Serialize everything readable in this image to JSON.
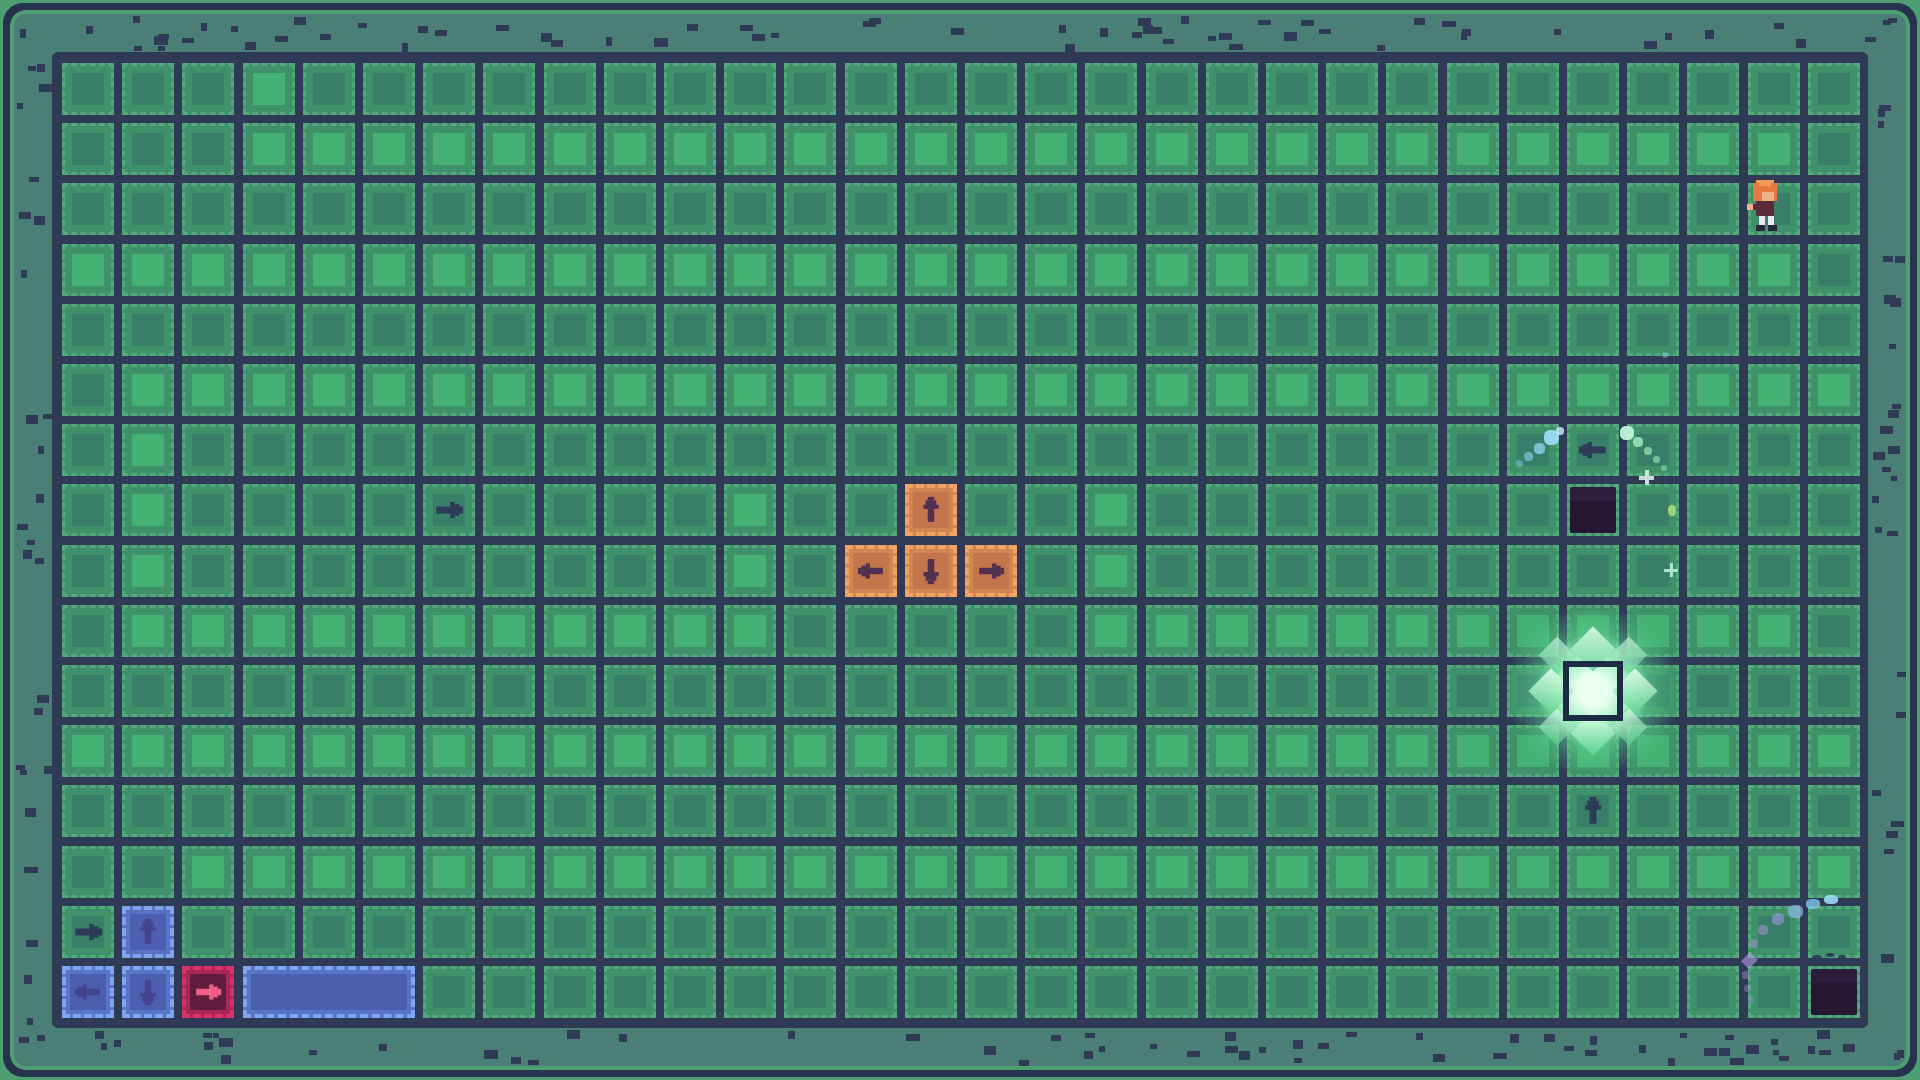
{
  "meta": {
    "app": "pixel-grid-puzzle-game",
    "scene": "garden-grid-level",
    "visible_text": "none"
  },
  "grid": {
    "cols": 30,
    "rows": 16,
    "origin_x": 62,
    "origin_y": 63,
    "pitch": 60.2,
    "cell_size": 52,
    "bright_cell_ranges_by_row": {
      "0": [
        [
          3,
          3
        ]
      ],
      "1": [
        [
          3,
          28
        ]
      ],
      "3": [
        [
          0,
          28
        ]
      ],
      "5": [
        [
          1,
          29
        ]
      ],
      "6": [
        [
          1,
          1
        ]
      ],
      "7": [
        [
          1,
          1
        ],
        [
          11,
          11
        ],
        [
          17,
          17
        ]
      ],
      "8": [
        [
          1,
          1
        ],
        [
          11,
          11
        ],
        [
          17,
          17
        ]
      ],
      "9": [
        [
          1,
          11
        ],
        [
          17,
          28
        ]
      ],
      "11": [
        [
          0,
          29
        ]
      ],
      "13": [
        [
          2,
          29
        ]
      ]
    }
  },
  "pieces": {
    "orange_arrow_tiles": [
      {
        "col": 14,
        "row": 7,
        "dir": "up"
      },
      {
        "col": 13,
        "row": 8,
        "dir": "left"
      },
      {
        "col": 14,
        "row": 8,
        "dir": "down"
      },
      {
        "col": 15,
        "row": 8,
        "dir": "right"
      }
    ],
    "blue_arrow_tiles": [
      {
        "col": 1,
        "row": 14,
        "dir": "up"
      },
      {
        "col": 0,
        "row": 15,
        "dir": "left"
      },
      {
        "col": 1,
        "row": 15,
        "dir": "down"
      }
    ],
    "pink_arrow_tiles": [
      {
        "col": 2,
        "row": 15,
        "dir": "right"
      }
    ],
    "blue_bar": {
      "col": 3,
      "row": 15,
      "span": 3
    },
    "ground_arrow_glyphs": [
      {
        "col": 6,
        "row": 7,
        "dir": "right"
      },
      {
        "col": 0,
        "row": 14,
        "dir": "right"
      },
      {
        "col": 25,
        "row": 6,
        "dir": "left"
      },
      {
        "col": 25,
        "row": 12,
        "dir": "up"
      }
    ],
    "dark_holes": [
      {
        "col": 25,
        "row": 7
      },
      {
        "col": 29,
        "row": 15
      }
    ],
    "glow_target": {
      "col": 25,
      "row": 10
    },
    "character": {
      "col": 28,
      "row": 2
    }
  },
  "colors": {
    "bg_navy": "#2e3a56",
    "frame_navy": "#27334e",
    "frame_green": "#4d9f72",
    "band_teal": "#4b7e74",
    "speckle": "#2e3a56",
    "cell_frame": "#3f9169",
    "cell_dash": "#54a87b",
    "cell_inner_dark": "#397e68",
    "cell_inner_bright": "#45b175",
    "glyph_arrow": "#2d3b57",
    "orange_border": "#f0a362",
    "orange_fill": "#d18551",
    "orange_inner": "#c4754b",
    "orange_arrow": "#513050",
    "blue_border": "#7fa5ec",
    "blue_fill": "#5873c8",
    "blue_inner": "#4c5fae",
    "blue_arrow": "#454390",
    "pink_border": "#d6336b",
    "pink_fill": "#a82753",
    "pink_inner": "#5f1c3e",
    "pink_arrow": "#f06087",
    "hole_top": "#2c1c3e",
    "hole_fill": "#241732",
    "glow_border": "#1e2b47",
    "glow_core": "#eafff2",
    "glow_mid": "#9ef0bd",
    "glow_outer": "#5fd694",
    "char_hair": "#e5793f",
    "char_hair_light": "#f29b57",
    "char_skin": "#f0b288",
    "char_body": "#5c2b3b",
    "char_legs": "#e9e9f0",
    "char_shoes": "#262738"
  },
  "particles": [
    {
      "x": 1516,
      "y": 460,
      "w": 7,
      "h": 7,
      "color": "#86d7f2",
      "opacity": 0.45,
      "shape": "dot"
    },
    {
      "x": 1524,
      "y": 452,
      "w": 9,
      "h": 9,
      "color": "#86d7f2",
      "opacity": 0.6,
      "shape": "dot"
    },
    {
      "x": 1534,
      "y": 443,
      "w": 11,
      "h": 11,
      "color": "#8fd9f4",
      "opacity": 0.75,
      "shape": "dot"
    },
    {
      "x": 1544,
      "y": 430,
      "w": 15,
      "h": 15,
      "color": "#9adcf6",
      "opacity": 0.95,
      "shape": "dot"
    },
    {
      "x": 1556,
      "y": 427,
      "w": 8,
      "h": 8,
      "color": "#c9ecfa",
      "opacity": 0.8,
      "shape": "dot"
    },
    {
      "x": 1620,
      "y": 426,
      "w": 14,
      "h": 14,
      "color": "#bff2dd",
      "opacity": 0.95,
      "shape": "dot"
    },
    {
      "x": 1633,
      "y": 437,
      "w": 10,
      "h": 10,
      "color": "#a5ecc2",
      "opacity": 0.8,
      "shape": "dot"
    },
    {
      "x": 1644,
      "y": 447,
      "w": 8,
      "h": 8,
      "color": "#a5ecc2",
      "opacity": 0.65,
      "shape": "dot"
    },
    {
      "x": 1653,
      "y": 456,
      "w": 7,
      "h": 7,
      "color": "#a5ecc2",
      "opacity": 0.55,
      "shape": "dot"
    },
    {
      "x": 1661,
      "y": 465,
      "w": 6,
      "h": 6,
      "color": "#a5ecc2",
      "opacity": 0.45,
      "shape": "dot"
    },
    {
      "x": 1639,
      "y": 470,
      "w": 15,
      "h": 15,
      "color": "#d8efe6",
      "opacity": 0.9,
      "shape": "cross"
    },
    {
      "x": 1668,
      "y": 505,
      "w": 8,
      "h": 11,
      "color": "#b9e87e",
      "opacity": 0.75,
      "shape": "dot"
    },
    {
      "x": 1664,
      "y": 563,
      "w": 14,
      "h": 14,
      "color": "#bff2dd",
      "opacity": 0.85,
      "shape": "cross"
    },
    {
      "x": 1662,
      "y": 352,
      "w": 6,
      "h": 6,
      "color": "#86d7f2",
      "opacity": 0.4,
      "shape": "dot"
    },
    {
      "x": 1824,
      "y": 895,
      "w": 14,
      "h": 9,
      "color": "#9adcf6",
      "opacity": 0.9,
      "shape": "dot"
    },
    {
      "x": 1806,
      "y": 899,
      "w": 14,
      "h": 10,
      "color": "#7fc4ee",
      "opacity": 0.8,
      "shape": "dot"
    },
    {
      "x": 1788,
      "y": 905,
      "w": 15,
      "h": 13,
      "color": "#8fb7e8",
      "opacity": 0.7,
      "shape": "dot"
    },
    {
      "x": 1772,
      "y": 913,
      "w": 12,
      "h": 12,
      "color": "#9a9ae0",
      "opacity": 0.6,
      "shape": "dot"
    },
    {
      "x": 1758,
      "y": 925,
      "w": 10,
      "h": 10,
      "color": "#a98fd8",
      "opacity": 0.55,
      "shape": "dot"
    },
    {
      "x": 1749,
      "y": 939,
      "w": 9,
      "h": 9,
      "color": "#a98fd8",
      "opacity": 0.5,
      "shape": "dot"
    },
    {
      "x": 1744,
      "y": 954,
      "w": 11,
      "h": 13,
      "color": "#b49ae2",
      "opacity": 0.6,
      "shape": "diamond"
    },
    {
      "x": 1742,
      "y": 971,
      "w": 8,
      "h": 8,
      "color": "#a98fd8",
      "opacity": 0.45,
      "shape": "dot"
    },
    {
      "x": 1744,
      "y": 985,
      "w": 7,
      "h": 7,
      "color": "#a98fd8",
      "opacity": 0.4,
      "shape": "dot"
    },
    {
      "x": 1748,
      "y": 997,
      "w": 6,
      "h": 6,
      "color": "#a98fd8",
      "opacity": 0.35,
      "shape": "dot"
    },
    {
      "x": 1812,
      "y": 955,
      "w": 10,
      "h": 4,
      "color": "#2e3a56",
      "opacity": 0.9,
      "shape": "dot"
    },
    {
      "x": 1826,
      "y": 953,
      "w": 8,
      "h": 4,
      "color": "#2e3a56",
      "opacity": 0.9,
      "shape": "dot"
    },
    {
      "x": 1838,
      "y": 955,
      "w": 8,
      "h": 4,
      "color": "#2e3a56",
      "opacity": 0.9,
      "shape": "dot"
    }
  ]
}
